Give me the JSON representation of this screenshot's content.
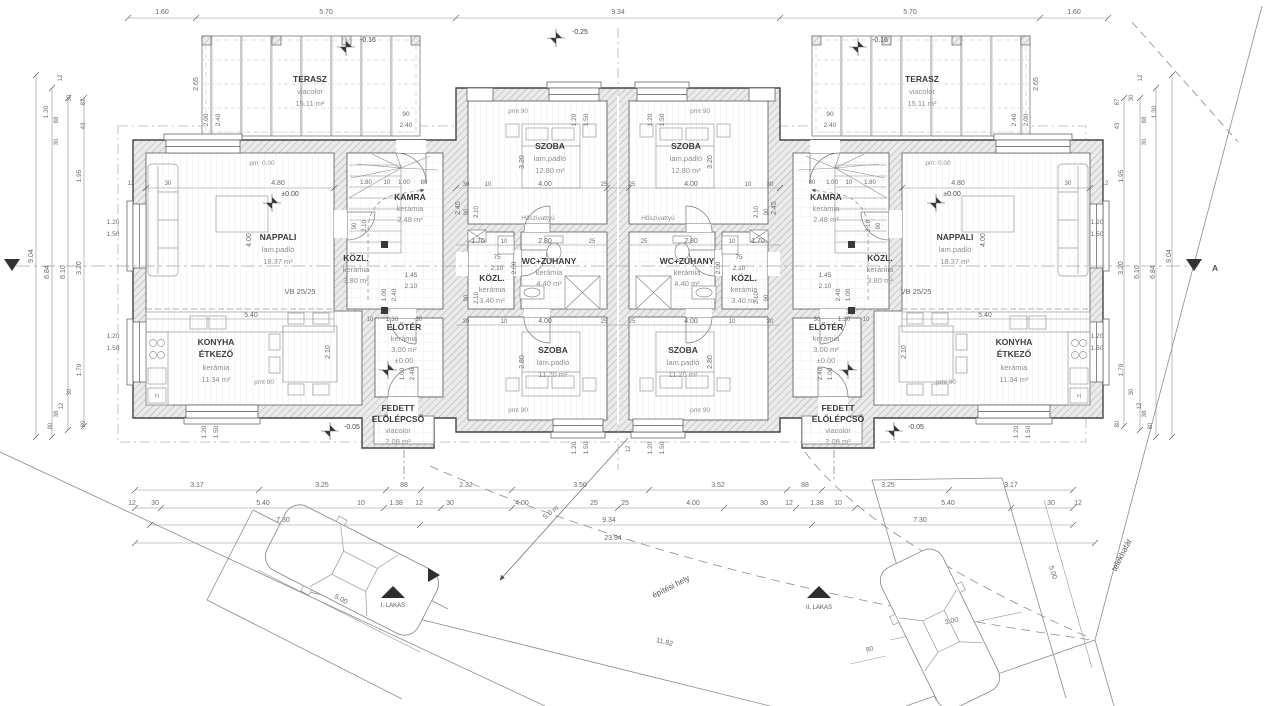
{
  "site": {
    "parcel_boundary": "telekhatár",
    "building_zone": "építési hely",
    "unit1": "I. LAKAS",
    "unit2": "II. LAKAS"
  },
  "rooms": {
    "terasz": {
      "name": "TERASZ",
      "floor": "viacolor",
      "area": "15.11 m²"
    },
    "nappali": {
      "name": "NAPPALI",
      "floor": "lam.padló",
      "area": "18.37 m²"
    },
    "konyha": {
      "line1": "KONYHA",
      "line2": "ÉTKEZŐ",
      "floor": "kerámia",
      "area": "11.34 m²"
    },
    "kamra": {
      "name": "KAMRA",
      "floor": "kerámia",
      "area": "2.48 m²"
    },
    "kozl_unit": {
      "name": "KÖZL.",
      "floor": "kerámia",
      "area": "3.80 m²"
    },
    "eloter": {
      "name": "ELŐTÉR",
      "floor": "kerámia",
      "area": "3.00 m²",
      "level": "±0.00"
    },
    "porch": {
      "line1": "FEDETT",
      "line2": "ELŐLÉPCSŐ",
      "floor": "viacolor",
      "area": "2.08 m²"
    },
    "szoba_felso": {
      "name": "SZOBA",
      "floor": "lam.padló",
      "area": "12.80 m²"
    },
    "szoba_also": {
      "name": "SZOBA",
      "floor": "lam.padló",
      "area": "11.20 m²"
    },
    "wc_zuhany": {
      "name": "WC+ZUHANY",
      "floor": "kerámia",
      "area": "4.40 m²"
    },
    "kozl_kozep": {
      "name": "KÖZL.",
      "floor": "kerámia",
      "area": "3.40 m²"
    }
  },
  "annotations": {
    "beam": "VB 25/25",
    "heatpump": "Hőszivattyú",
    "section": "A",
    "appliance": "H"
  },
  "dim_labels": [
    {
      "t": "1.60",
      "x": 162,
      "y": 14
    },
    {
      "t": "5.70",
      "x": 326,
      "y": 14
    },
    {
      "t": "9.34",
      "x": 618,
      "y": 14
    },
    {
      "t": "5.70",
      "x": 910,
      "y": 14
    },
    {
      "t": "1.60",
      "x": 1074,
      "y": 14
    },
    {
      "t": "3.17",
      "x": 197,
      "y": 487
    },
    {
      "t": "3.25",
      "x": 322,
      "y": 487
    },
    {
      "t": "88",
      "x": 404,
      "y": 487
    },
    {
      "t": "2.32",
      "x": 466,
      "y": 487
    },
    {
      "t": "3.50",
      "x": 580,
      "y": 487
    },
    {
      "t": "3.52",
      "x": 718,
      "y": 487
    },
    {
      "t": "88",
      "x": 805,
      "y": 487
    },
    {
      "t": "3.25",
      "x": 888,
      "y": 487
    },
    {
      "t": "3.17",
      "x": 1011,
      "y": 487
    },
    {
      "t": "12",
      "x": 132,
      "y": 505
    },
    {
      "t": "30",
      "x": 155,
      "y": 505
    },
    {
      "t": "5.40",
      "x": 263,
      "y": 505
    },
    {
      "t": "10",
      "x": 361,
      "y": 505
    },
    {
      "t": "1.38",
      "x": 396,
      "y": 505
    },
    {
      "t": "12",
      "x": 419,
      "y": 505
    },
    {
      "t": "30",
      "x": 450,
      "y": 505
    },
    {
      "t": "4.00",
      "x": 522,
      "y": 505
    },
    {
      "t": "25",
      "x": 594,
      "y": 505
    },
    {
      "t": "25",
      "x": 625,
      "y": 505
    },
    {
      "t": "4.00",
      "x": 693,
      "y": 505
    },
    {
      "t": "30",
      "x": 764,
      "y": 505
    },
    {
      "t": "12",
      "x": 789,
      "y": 505
    },
    {
      "t": "1.38",
      "x": 817,
      "y": 505
    },
    {
      "t": "10",
      "x": 838,
      "y": 505
    },
    {
      "t": "5.40",
      "x": 948,
      "y": 505
    },
    {
      "t": "30",
      "x": 1051,
      "y": 505
    },
    {
      "t": "12",
      "x": 1078,
      "y": 505
    },
    {
      "t": "7.30",
      "x": 283,
      "y": 522
    },
    {
      "t": "9.34",
      "x": 609,
      "y": 522
    },
    {
      "t": "7.30",
      "x": 920,
      "y": 522
    },
    {
      "t": "23.94",
      "x": 613,
      "y": 540
    },
    {
      "t": "9.04",
      "x": 33,
      "y": 256,
      "r": -90
    },
    {
      "t": "6.84",
      "x": 49,
      "y": 272,
      "r": -90
    },
    {
      "t": "6.10",
      "x": 65,
      "y": 272,
      "r": -90
    },
    {
      "t": "3.20",
      "x": 81,
      "y": 268,
      "r": -90
    },
    {
      "t": "1.30",
      "x": 48,
      "y": 112,
      "r": -90,
      "fs": 6.5
    },
    {
      "t": "12",
      "x": 62,
      "y": 78,
      "r": -90,
      "fs": 6
    },
    {
      "t": "88",
      "x": 58,
      "y": 120,
      "r": -90,
      "fs": 6
    },
    {
      "t": "30",
      "x": 58,
      "y": 142,
      "r": -90,
      "fs": 6
    },
    {
      "t": "87",
      "x": 85,
      "y": 102,
      "r": -90,
      "fs": 6
    },
    {
      "t": "43",
      "x": 85,
      "y": 126,
      "r": -90,
      "fs": 6
    },
    {
      "t": "30",
      "x": 71,
      "y": 98,
      "r": -90,
      "fs": 6
    },
    {
      "t": "1.95",
      "x": 81,
      "y": 176,
      "r": -90,
      "fs": 6.5
    },
    {
      "t": "1.79",
      "x": 81,
      "y": 370,
      "r": -90,
      "fs": 6.5
    },
    {
      "t": "30",
      "x": 71,
      "y": 392,
      "r": -90,
      "fs": 6
    },
    {
      "t": "12",
      "x": 63,
      "y": 406,
      "r": -90,
      "fs": 6
    },
    {
      "t": "38",
      "x": 58,
      "y": 414,
      "r": -90,
      "fs": 6
    },
    {
      "t": "80",
      "x": 52,
      "y": 426,
      "r": -90,
      "fs": 6
    },
    {
      "t": "80",
      "x": 85,
      "y": 424,
      "r": -90,
      "fs": 6
    },
    {
      "t": "9.04",
      "x": 1171,
      "y": 256,
      "r": -90
    },
    {
      "t": "6.84",
      "x": 1155,
      "y": 272,
      "r": -90
    },
    {
      "t": "6.10",
      "x": 1139,
      "y": 272,
      "r": -90
    },
    {
      "t": "3.20",
      "x": 1123,
      "y": 268,
      "r": -90
    },
    {
      "t": "1.30",
      "x": 1156,
      "y": 112,
      "r": -90,
      "fs": 6.5
    },
    {
      "t": "12",
      "x": 1142,
      "y": 78,
      "r": -90,
      "fs": 6
    },
    {
      "t": "88",
      "x": 1146,
      "y": 120,
      "r": -90,
      "fs": 6
    },
    {
      "t": "30",
      "x": 1146,
      "y": 142,
      "r": -90,
      "fs": 6
    },
    {
      "t": "87",
      "x": 1119,
      "y": 102,
      "r": -90,
      "fs": 6
    },
    {
      "t": "43",
      "x": 1119,
      "y": 126,
      "r": -90,
      "fs": 6
    },
    {
      "t": "30",
      "x": 1133,
      "y": 98,
      "r": -90,
      "fs": 6
    },
    {
      "t": "1.95",
      "x": 1123,
      "y": 176,
      "r": -90,
      "fs": 6.5
    },
    {
      "t": "1.79",
      "x": 1123,
      "y": 370,
      "r": -90,
      "fs": 6.5
    },
    {
      "t": "30",
      "x": 1133,
      "y": 392,
      "r": -90,
      "fs": 6
    },
    {
      "t": "12",
      "x": 1141,
      "y": 406,
      "r": -90,
      "fs": 6
    },
    {
      "t": "38",
      "x": 1146,
      "y": 414,
      "r": -90,
      "fs": 6
    },
    {
      "t": "80",
      "x": 1152,
      "y": 426,
      "r": -90,
      "fs": 6
    },
    {
      "t": "80",
      "x": 1119,
      "y": 424,
      "r": -90,
      "fs": 6
    },
    {
      "t": "1.20",
      "x": 113,
      "y": 224,
      "fs": 6.5
    },
    {
      "t": "1.50",
      "x": 113,
      "y": 236,
      "fs": 6.5
    },
    {
      "t": "1.20",
      "x": 113,
      "y": 338,
      "fs": 6.5
    },
    {
      "t": "1.50",
      "x": 113,
      "y": 350,
      "fs": 6.5
    },
    {
      "t": "1.20",
      "x": 1097,
      "y": 224,
      "fs": 6.5
    },
    {
      "t": "1.50",
      "x": 1097,
      "y": 236,
      "fs": 6.5
    },
    {
      "t": "1.20",
      "x": 1097,
      "y": 338,
      "fs": 6.5
    },
    {
      "t": "1.50",
      "x": 1097,
      "y": 350,
      "fs": 6.5
    },
    {
      "t": "1.20",
      "x": 576,
      "y": 120,
      "r": -90,
      "fs": 6.5
    },
    {
      "t": "1.50",
      "x": 588,
      "y": 120,
      "r": -90,
      "fs": 6.5
    },
    {
      "t": "1.20",
      "x": 652,
      "y": 120,
      "r": -90,
      "fs": 6.5
    },
    {
      "t": "1.50",
      "x": 664,
      "y": 120,
      "r": -90,
      "fs": 6.5
    },
    {
      "t": "1.20",
      "x": 576,
      "y": 448,
      "r": -90,
      "fs": 6.5
    },
    {
      "t": "1.50",
      "x": 588,
      "y": 448,
      "r": -90,
      "fs": 6.5
    },
    {
      "t": "1.20",
      "x": 652,
      "y": 448,
      "r": -90,
      "fs": 6.5
    },
    {
      "t": "1.50",
      "x": 664,
      "y": 448,
      "r": -90,
      "fs": 6.5
    },
    {
      "t": "1.20",
      "x": 206,
      "y": 432,
      "r": -90,
      "fs": 6.5
    },
    {
      "t": "1.50",
      "x": 218,
      "y": 432,
      "r": -90,
      "fs": 6.5
    },
    {
      "t": "1.20",
      "x": 1018,
      "y": 432,
      "r": -90,
      "fs": 6.5
    },
    {
      "t": "1.50",
      "x": 1030,
      "y": 432,
      "r": -90,
      "fs": 6.5
    },
    {
      "t": "2.65",
      "x": 198,
      "y": 84,
      "r": -90
    },
    {
      "t": "2.00",
      "x": 208,
      "y": 120,
      "r": -90,
      "fs": 6.5
    },
    {
      "t": "2.40",
      "x": 220,
      "y": 120,
      "r": -90,
      "fs": 6.5
    },
    {
      "t": "90",
      "x": 406,
      "y": 116,
      "fs": 6.5
    },
    {
      "t": "2.40",
      "x": 406,
      "y": 127,
      "fs": 6.5
    },
    {
      "t": "2.65",
      "x": 1038,
      "y": 84,
      "r": -90
    },
    {
      "t": "2.00",
      "x": 1028,
      "y": 120,
      "r": -90,
      "fs": 6.5
    },
    {
      "t": "2.40",
      "x": 1016,
      "y": 120,
      "r": -90,
      "fs": 6.5
    },
    {
      "t": "90",
      "x": 830,
      "y": 116,
      "fs": 6.5
    },
    {
      "t": "2.40",
      "x": 830,
      "y": 127,
      "fs": 6.5
    },
    {
      "t": "-0.25",
      "x": 572,
      "y": 34,
      "a": "start",
      "c": "#4a4a4a"
    },
    {
      "t": "-0.16",
      "x": 360,
      "y": 42,
      "a": "start",
      "c": "#4a4a4a"
    },
    {
      "t": "-0.16",
      "x": 872,
      "y": 42,
      "a": "start",
      "c": "#4a4a4a"
    },
    {
      "t": "-0.05",
      "x": 344,
      "y": 429,
      "a": "start",
      "c": "#4a4a4a"
    },
    {
      "t": "-0.05",
      "x": 908,
      "y": 429,
      "a": "start",
      "c": "#4a4a4a"
    },
    {
      "t": "±0.00",
      "x": 290,
      "y": 196,
      "c": "#4a4a4a"
    },
    {
      "t": "±0.00",
      "x": 952,
      "y": 196,
      "c": "#4a4a4a"
    },
    {
      "t": "pm: 0.00",
      "x": 262,
      "y": 165,
      "fs": 6.5,
      "c": "#8f8f8f"
    },
    {
      "t": "pm: 0.00",
      "x": 938,
      "y": 165,
      "fs": 6.5,
      "c": "#8f8f8f"
    },
    {
      "t": "pmt 90",
      "x": 264,
      "y": 384,
      "fs": 6.5,
      "c": "#8f8f8f"
    },
    {
      "t": "pmt 90",
      "x": 946,
      "y": 384,
      "fs": 6.5,
      "c": "#8f8f8f"
    },
    {
      "t": "pmt 90",
      "x": 518,
      "y": 113,
      "fs": 6.5,
      "c": "#8f8f8f"
    },
    {
      "t": "pmt 90",
      "x": 700,
      "y": 113,
      "fs": 6.5,
      "c": "#8f8f8f"
    },
    {
      "t": "pmt 90",
      "x": 518,
      "y": 412,
      "fs": 6.5,
      "c": "#8f8f8f"
    },
    {
      "t": "pmt 90",
      "x": 700,
      "y": 412,
      "fs": 6.5,
      "c": "#8f8f8f"
    },
    {
      "t": "4.80",
      "x": 278,
      "y": 185
    },
    {
      "t": "30",
      "x": 168,
      "y": 185,
      "fs": 6
    },
    {
      "t": "12",
      "x": 131,
      "y": 185,
      "fs": 6
    },
    {
      "t": "4.00",
      "x": 251,
      "y": 240,
      "r": -90
    },
    {
      "t": "5.40",
      "x": 251,
      "y": 317
    },
    {
      "t": "2.10",
      "x": 330,
      "y": 352,
      "r": -90
    },
    {
      "t": "4.80",
      "x": 958,
      "y": 185
    },
    {
      "t": "30",
      "x": 1068,
      "y": 185,
      "fs": 6
    },
    {
      "t": "12",
      "x": 1105,
      "y": 185,
      "fs": 6
    },
    {
      "t": "4.00",
      "x": 985,
      "y": 240,
      "r": -90
    },
    {
      "t": "5.40",
      "x": 985,
      "y": 317
    },
    {
      "t": "2.10",
      "x": 906,
      "y": 352,
      "r": -90
    },
    {
      "t": "1.45",
      "x": 411,
      "y": 277,
      "fs": 6.5
    },
    {
      "t": "2.10",
      "x": 411,
      "y": 288,
      "fs": 6.5
    },
    {
      "t": "1.00",
      "x": 386,
      "y": 295,
      "r": -90,
      "fs": 6.5
    },
    {
      "t": "2.40",
      "x": 396,
      "y": 295,
      "r": -90,
      "fs": 6.5
    },
    {
      "t": "1.30",
      "x": 392,
      "y": 321,
      "fs": 6.5
    },
    {
      "t": "30",
      "x": 419,
      "y": 321,
      "fs": 6
    },
    {
      "t": "10",
      "x": 370,
      "y": 321,
      "fs": 6
    },
    {
      "t": "1.80",
      "x": 366,
      "y": 184,
      "fs": 6
    },
    {
      "t": "10",
      "x": 387,
      "y": 184,
      "fs": 6
    },
    {
      "t": "1.00",
      "x": 404,
      "y": 184,
      "fs": 6
    },
    {
      "t": "80",
      "x": 424,
      "y": 184,
      "fs": 6
    },
    {
      "t": "1.00",
      "x": 404,
      "y": 374,
      "r": -90,
      "fs": 6.5
    },
    {
      "t": "2.40",
      "x": 414,
      "y": 374,
      "r": -90,
      "fs": 6.5
    },
    {
      "t": "1.45",
      "x": 825,
      "y": 277,
      "fs": 6.5
    },
    {
      "t": "2.10",
      "x": 825,
      "y": 288,
      "fs": 6.5
    },
    {
      "t": "1.00",
      "x": 850,
      "y": 295,
      "r": -90,
      "fs": 6.5
    },
    {
      "t": "2.40",
      "x": 840,
      "y": 295,
      "r": -90,
      "fs": 6.5
    },
    {
      "t": "1.30",
      "x": 844,
      "y": 321,
      "fs": 6.5
    },
    {
      "t": "30",
      "x": 817,
      "y": 321,
      "fs": 6
    },
    {
      "t": "10",
      "x": 866,
      "y": 321,
      "fs": 6
    },
    {
      "t": "1.80",
      "x": 870,
      "y": 184,
      "fs": 6
    },
    {
      "t": "10",
      "x": 849,
      "y": 184,
      "fs": 6
    },
    {
      "t": "1.00",
      "x": 832,
      "y": 184,
      "fs": 6
    },
    {
      "t": "80",
      "x": 812,
      "y": 184,
      "fs": 6
    },
    {
      "t": "1.00",
      "x": 832,
      "y": 374,
      "r": -90,
      "fs": 6.5
    },
    {
      "t": "2.40",
      "x": 822,
      "y": 374,
      "r": -90,
      "fs": 6.5
    },
    {
      "t": "30",
      "x": 466,
      "y": 186,
      "fs": 6
    },
    {
      "t": "10",
      "x": 488,
      "y": 186,
      "fs": 6
    },
    {
      "t": "4.00",
      "x": 545,
      "y": 186
    },
    {
      "t": "25",
      "x": 604,
      "y": 186,
      "fs": 6
    },
    {
      "t": "25",
      "x": 632,
      "y": 186,
      "fs": 6
    },
    {
      "t": "4.00",
      "x": 691,
      "y": 186
    },
    {
      "t": "10",
      "x": 748,
      "y": 186,
      "fs": 6
    },
    {
      "t": "30",
      "x": 770,
      "y": 186,
      "fs": 6
    },
    {
      "t": "1.70",
      "x": 478,
      "y": 243
    },
    {
      "t": "10",
      "x": 504,
      "y": 243,
      "fs": 6
    },
    {
      "t": "2.80",
      "x": 545,
      "y": 243
    },
    {
      "t": "25",
      "x": 592,
      "y": 243,
      "fs": 6
    },
    {
      "t": "25",
      "x": 644,
      "y": 243,
      "fs": 6
    },
    {
      "t": "2.80",
      "x": 691,
      "y": 243
    },
    {
      "t": "10",
      "x": 732,
      "y": 243,
      "fs": 6
    },
    {
      "t": "1.70",
      "x": 758,
      "y": 243
    },
    {
      "t": "4.00",
      "x": 545,
      "y": 323
    },
    {
      "t": "25",
      "x": 604,
      "y": 323,
      "fs": 6
    },
    {
      "t": "25",
      "x": 632,
      "y": 323,
      "fs": 6
    },
    {
      "t": "4.00",
      "x": 691,
      "y": 323
    },
    {
      "t": "10",
      "x": 504,
      "y": 323,
      "fs": 6
    },
    {
      "t": "30",
      "x": 466,
      "y": 323,
      "fs": 6
    },
    {
      "t": "10",
      "x": 732,
      "y": 323,
      "fs": 6
    },
    {
      "t": "30",
      "x": 770,
      "y": 323,
      "fs": 6
    },
    {
      "t": "75",
      "x": 497,
      "y": 259,
      "fs": 6.5
    },
    {
      "t": "2.10",
      "x": 497,
      "y": 270,
      "fs": 6.5
    },
    {
      "t": "75",
      "x": 739,
      "y": 259,
      "fs": 6.5
    },
    {
      "t": "2.10",
      "x": 739,
      "y": 270,
      "fs": 6.5
    },
    {
      "t": "3.20",
      "x": 524,
      "y": 162,
      "r": -90
    },
    {
      "t": "3.20",
      "x": 712,
      "y": 162,
      "r": -90
    },
    {
      "t": "2.80",
      "x": 524,
      "y": 362,
      "r": -90
    },
    {
      "t": "2.80",
      "x": 712,
      "y": 362,
      "r": -90
    },
    {
      "t": "2.45",
      "x": 460,
      "y": 208,
      "r": -90
    },
    {
      "t": "2.45",
      "x": 776,
      "y": 208,
      "r": -90
    },
    {
      "t": "2.00",
      "x": 516,
      "y": 268,
      "r": -90,
      "fs": 6.5
    },
    {
      "t": "2.00",
      "x": 720,
      "y": 268,
      "r": -90,
      "fs": 6.5
    },
    {
      "t": "90",
      "x": 468,
      "y": 212,
      "r": -90,
      "fs": 6
    },
    {
      "t": "2.10",
      "x": 478,
      "y": 212,
      "r": -90,
      "fs": 6
    },
    {
      "t": "90",
      "x": 768,
      "y": 212,
      "r": -90,
      "fs": 6
    },
    {
      "t": "2.10",
      "x": 758,
      "y": 212,
      "r": -90,
      "fs": 6
    },
    {
      "t": "90",
      "x": 468,
      "y": 298,
      "r": -90,
      "fs": 6
    },
    {
      "t": "2.10",
      "x": 478,
      "y": 298,
      "r": -90,
      "fs": 6
    },
    {
      "t": "90",
      "x": 768,
      "y": 298,
      "r": -90,
      "fs": 6
    },
    {
      "t": "2.10",
      "x": 758,
      "y": 298,
      "r": -90,
      "fs": 6
    },
    {
      "t": "90",
      "x": 356,
      "y": 226,
      "r": -90,
      "fs": 6
    },
    {
      "t": "2.10",
      "x": 366,
      "y": 226,
      "r": -90,
      "fs": 6
    },
    {
      "t": "90",
      "x": 880,
      "y": 226,
      "r": -90,
      "fs": 6
    },
    {
      "t": "2.10",
      "x": 870,
      "y": 226,
      "r": -90,
      "fs": 6
    },
    {
      "t": "12",
      "x": 630,
      "y": 449,
      "r": -90,
      "fs": 6
    },
    {
      "t": "5.00",
      "x": 340,
      "y": 601,
      "r": 27
    },
    {
      "t": "3.00",
      "x": 952,
      "y": 623,
      "r": -12
    },
    {
      "t": "80",
      "x": 870,
      "y": 651,
      "r": -12,
      "fs": 6.5
    },
    {
      "t": "5.00",
      "x": 1051,
      "y": 573,
      "r": 73
    },
    {
      "t": "5.0 m",
      "x": 552,
      "y": 514,
      "r": -38
    },
    {
      "t": "11.82",
      "x": 664,
      "y": 644,
      "r": 14
    }
  ]
}
